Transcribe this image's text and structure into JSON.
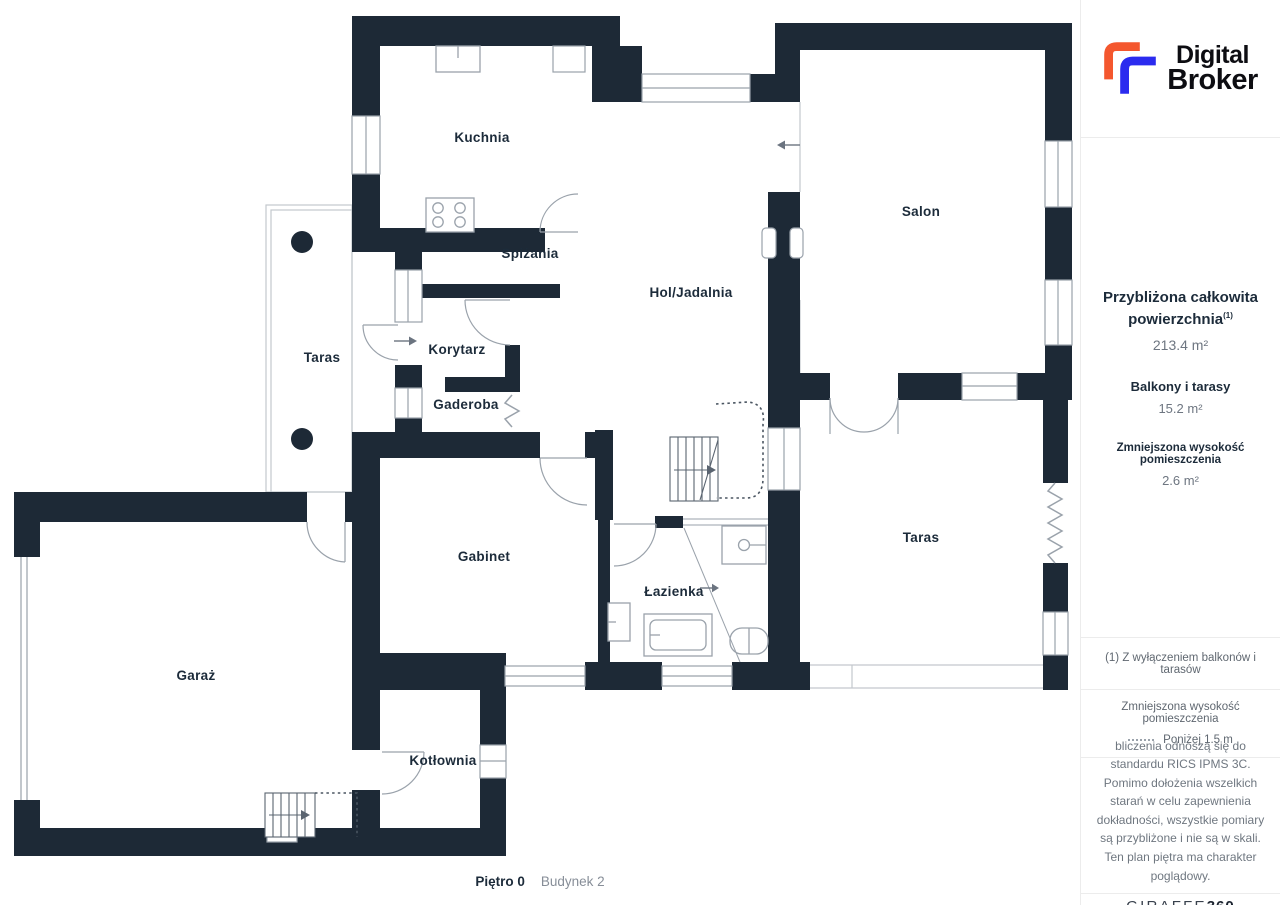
{
  "header_logo": {
    "line1": "Digital",
    "line2": "Broker",
    "orange": "#F4572E",
    "blue": "#2B2BEF"
  },
  "plan": {
    "rooms": [
      {
        "id": "kuchnia",
        "label": "Kuchnia"
      },
      {
        "id": "spizania",
        "label": "Spiżania"
      },
      {
        "id": "hol-jadalnia",
        "label": "Hol/Jadalnia"
      },
      {
        "id": "salon",
        "label": "Salon"
      },
      {
        "id": "taras-left",
        "label": "Taras"
      },
      {
        "id": "korytarz",
        "label": "Korytarz"
      },
      {
        "id": "gaderoba",
        "label": "Gaderoba"
      },
      {
        "id": "gabinet",
        "label": "Gabinet"
      },
      {
        "id": "lazienka",
        "label": "Łazienka"
      },
      {
        "id": "taras-right",
        "label": "Taras"
      },
      {
        "id": "garaz",
        "label": "Garaż"
      },
      {
        "id": "kotlownia",
        "label": "Kotłownia"
      }
    ],
    "caption": {
      "floor": "Piętro 0",
      "building": "Budynek 2"
    }
  },
  "sidebar": {
    "stats": {
      "total_label_line1": "Przybliżona całkowita",
      "total_label_line2": "powierzchnia",
      "total_sup": "(1)",
      "total_value": "213.4 m²",
      "balconies_label": "Balkony i tarasy",
      "balconies_value": "15.2 m²",
      "reduced_label": "Zmniejszona wysokość pomieszczenia",
      "reduced_value": "2.6 m²"
    },
    "footnote": "(1) Z wyłączeniem balkonów i tarasów",
    "legend": {
      "title": "Zmniejszona wysokość pomieszczenia",
      "dash_label": "Poniżej 1.5 m"
    },
    "disclaimer": "bliczenia odnoszą się do standardu RICS IPMS 3C. Pomimo dołożenia wszelkich starań w celu zapewnienia dokładności, wszystkie pomiary są przybliżone i nie są w skali. Ten plan piętra ma charakter poglądowy.",
    "brand": {
      "name": "GIRAFFE",
      "suffix": "360"
    }
  },
  "colors": {
    "wall": "#1D2936",
    "line": "#9AA2AB",
    "label": "#1C2B3A",
    "dotted": "#4A5561"
  }
}
